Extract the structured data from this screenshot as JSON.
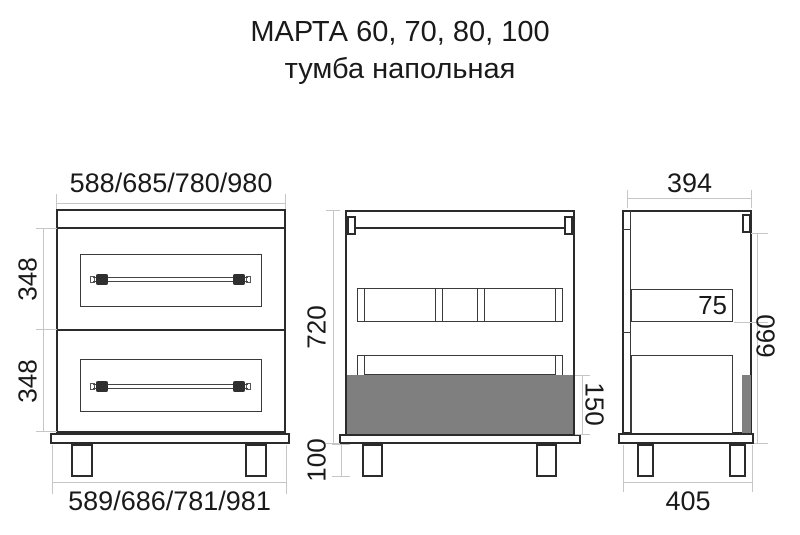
{
  "title": {
    "line1": "МАРТА 60, 70, 80, 100",
    "line2": "тумба напольная"
  },
  "front_view": {
    "width_top": "588/685/780/980",
    "width_bottom": "589/686/781/981",
    "drawer1_height": "348",
    "drawer2_height": "348"
  },
  "section_view": {
    "body_height": "720",
    "leg_height": "100",
    "drawer_box_height": "150"
  },
  "side_view": {
    "depth_top": "394",
    "depth_bottom": "405",
    "rail_height": "75",
    "side_height": "660"
  },
  "colors": {
    "outline": "#2b2b2b",
    "dimension": "#c6c6c6",
    "fill_gray": "#7f7f7f",
    "text": "#1a1a1a"
  }
}
